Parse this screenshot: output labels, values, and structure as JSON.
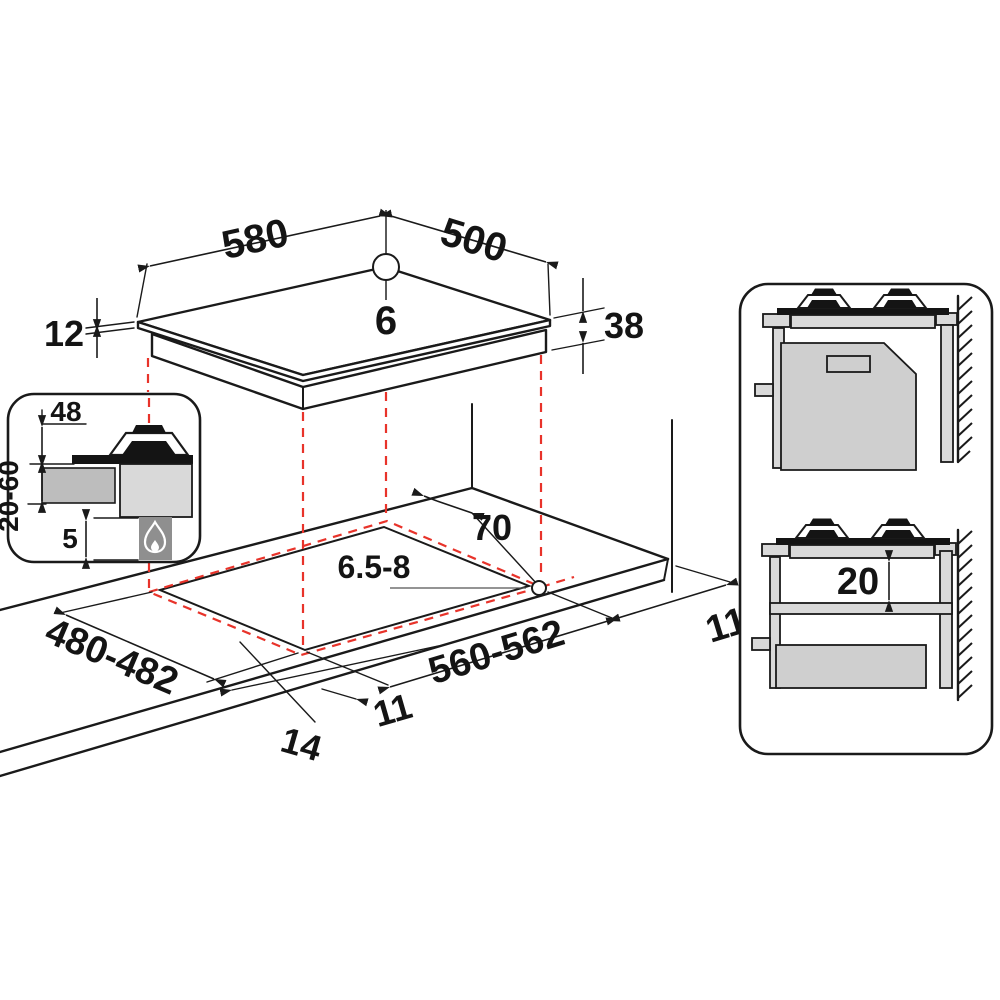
{
  "title": "Gas hob built-in installation dimensions diagram",
  "colors": {
    "line": "#1a1a1a",
    "dashed_projection": "#e8332a",
    "gray_light": "#d9d9d9",
    "gray_mid": "#bdbdbd",
    "gray_dark": "#8f8f8f",
    "background": "#ffffff"
  },
  "hob_top_view": {
    "width": "580",
    "depth": "500",
    "hole_diameter": "6",
    "glass_thickness": "12",
    "total_height": "38"
  },
  "burner_detail_inset": {
    "burner_height": "48",
    "worktop_thickness": "20-60",
    "bottom_clearance": "5",
    "icon": "flame-icon"
  },
  "worktop_cutout_view": {
    "rear_clearance": "70",
    "fixing_hole_diameter": "6.5-8",
    "cutout_depth": "480-482",
    "cutout_width": "560-562",
    "side_clearance": "110",
    "front_offset": "14",
    "side_offset": "11"
  },
  "installation_side_views": {
    "min_shelf_gap": "20"
  }
}
